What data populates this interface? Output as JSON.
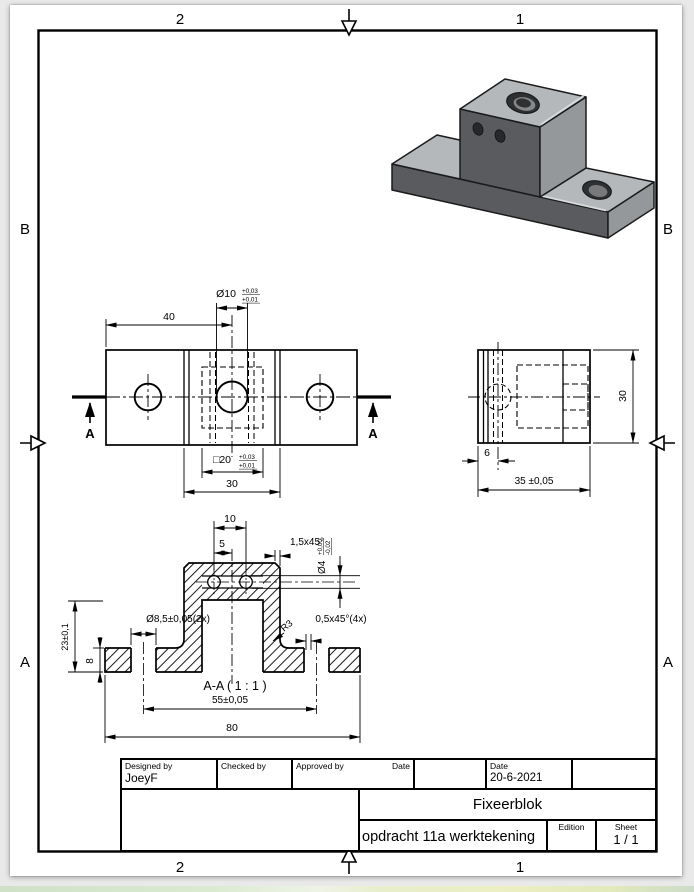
{
  "border": {
    "top": [
      "2",
      "1"
    ],
    "bottom": [
      "2",
      "1"
    ],
    "left": [
      "B",
      "A"
    ],
    "right": [
      "B",
      "A"
    ]
  },
  "top_view": {
    "dim_40": "40",
    "dim_d10": "Ø10",
    "d10_tol_up": "+0,03",
    "d10_tol_lo": "+0,01",
    "dim_sq20": "□20",
    "sq20_tol_up": "+0,03",
    "sq20_tol_lo": "+0,01",
    "dim_30": "30",
    "section_label_left": "A",
    "section_label_right": "A"
  },
  "side_view": {
    "dim_30": "30",
    "dim_6": "6",
    "dim_35": "35 ±0,05"
  },
  "section_view": {
    "dim_10": "10",
    "dim_5": "5",
    "chamfer_top": "1,5x45°",
    "dim_d4": "Ø4",
    "d4_tol_up": "+0,00",
    "d4_tol_lo": "-0,02",
    "dim_d85": "Ø8,5±0,05(2x)",
    "fillet": "R3",
    "chamfer_cb": "0,5x45°(4x)",
    "dim_23": "23±0,1",
    "dim_8": "8",
    "view_label": "A-A ( 1 : 1 )",
    "dim_55": "55±0,05",
    "dim_80": "80"
  },
  "title_block": {
    "designed_by_label": "Designed by",
    "designed_by": "JoeyF",
    "checked_by_label": "Checked by",
    "approved_by_label": "Approved by",
    "date_label_1": "Date",
    "date_label_2": "Date",
    "date_value": "20-6-2021",
    "part_title": "Fixeerblok",
    "drawing_title": "opdracht 11a werktekening",
    "edition_label": "Edition",
    "sheet_label": "Sheet",
    "sheet_value": "1 / 1"
  }
}
